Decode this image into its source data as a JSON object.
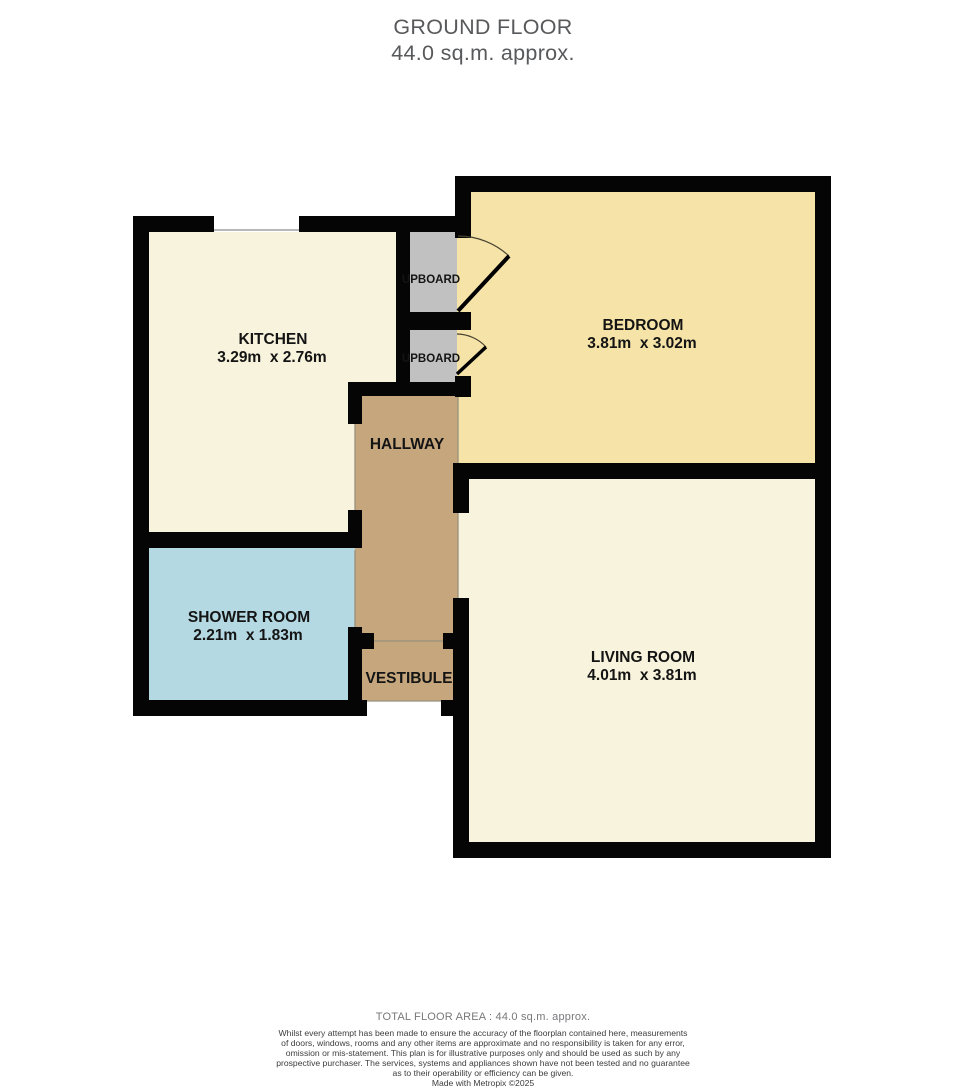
{
  "title": {
    "line1": "GROUND FLOOR",
    "line2": "44.0 sq.m. approx."
  },
  "rooms": {
    "kitchen": {
      "name": "KITCHEN",
      "dims": "3.29m  x 2.76m",
      "color": "#f8f3dc"
    },
    "bedroom": {
      "name": "BEDROOM",
      "dims": "3.81m  x 3.02m",
      "color": "#f5e3a7"
    },
    "hallway": {
      "name": "HALLWAY",
      "color": "#c6a77d"
    },
    "shower_room": {
      "name": "SHOWER ROOM",
      "dims": "2.21m  x 1.83m",
      "color": "#b5d9e2"
    },
    "vestibule": {
      "name": "VESTIBULE",
      "color": "#c6a77d"
    },
    "living_room": {
      "name": "LIVING ROOM",
      "dims": "4.01m  x 3.81m",
      "color": "#f8f3dc"
    },
    "cupboard_top": {
      "name": "UPBOARD",
      "color": "#c2c1c1"
    },
    "cupboard_bottom": {
      "name": "UPBOARD",
      "color": "#c2c1c1"
    }
  },
  "colors": {
    "wall": "#050505",
    "label_text": "#141414",
    "door_leaf": "#000000",
    "door_arc": "#46412f",
    "opening_line": "#98907c",
    "window_line": "#8d8d8d"
  },
  "footer": {
    "total": "TOTAL FLOOR AREA : 44.0 sq.m. approx.",
    "disclaimer_lines": [
      "Whilst every attempt has been made to ensure the accuracy of the floorplan contained here, measurements",
      "of doors, windows, rooms and any other items are approximate and no responsibility is taken for any error,",
      "omission or mis-statement. This plan is for illustrative purposes only and should be used as such by any",
      "prospective purchaser. The services, systems and appliances shown have not been tested and no guarantee",
      "as to their operability or efficiency can be given."
    ],
    "credit": "Made with Metropix ©2025"
  }
}
